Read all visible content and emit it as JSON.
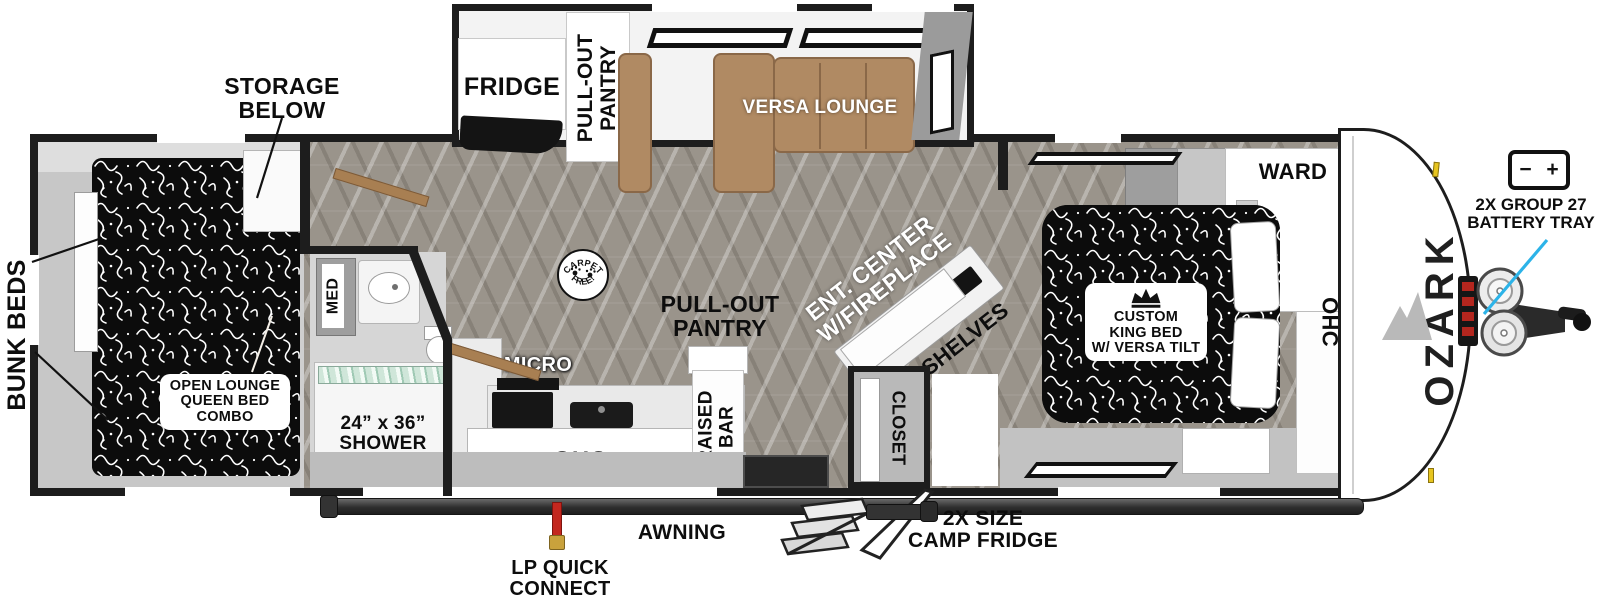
{
  "title": "OZARK travel trailer floorplan",
  "brand": {
    "logo_text": "OZARK"
  },
  "exterior": {
    "storage_below": "STORAGE\nBELOW",
    "bunk_beds": "BUNK BEDS",
    "battery_icon": {
      "minus": "−",
      "plus": "+"
    },
    "battery_tray": "2X GROUP 27\nBATTERY TRAY",
    "awning": "AWNING",
    "lp_quick_connect": "LP QUICK\nCONNECT",
    "camp_fridge": "2X SIZE\nCAMP FRIDGE"
  },
  "interior": {
    "bunk_room": {
      "open_lounge_queen_bed": "OPEN LOUNGE\nQUEEN BED\nCOMBO"
    },
    "bathroom": {
      "med_cabinet": "MED",
      "shower": "24” x 36”\nSHOWER"
    },
    "kitchen": {
      "micro": "MICRO",
      "overhead_cabinet": "OHC",
      "raised_bar": "RAISED\nBAR"
    },
    "galley_slide": {
      "fridge": "FRIDGE",
      "pull_out_pantry": "PULL-OUT\nPANTRY",
      "versa_lounge": "VERSA LOUNGE"
    },
    "living": {
      "pull_out_pantry": "PULL-OUT\nPANTRY",
      "carpet_badge_top": "CARPET",
      "carpet_badge_bottom": "FREE!",
      "ent_center": "ENT. CENTER\nW/FIREPLACE",
      "shelves": "SHELVES",
      "closet": "CLOSET"
    },
    "bedroom": {
      "king_bed": "CUSTOM\nKING BED\nW/ VERSA TILT",
      "wardrobe": "WARD",
      "overhead_cabinet": "OHC"
    }
  },
  "colors": {
    "accent_leader": "#2cb3e8",
    "wall": "#1d1d1d",
    "sofa": "#b08a63",
    "fireplace_glow": "#f0941e",
    "lp_connect_red": "#c3271f",
    "floor": "#9a948b"
  }
}
